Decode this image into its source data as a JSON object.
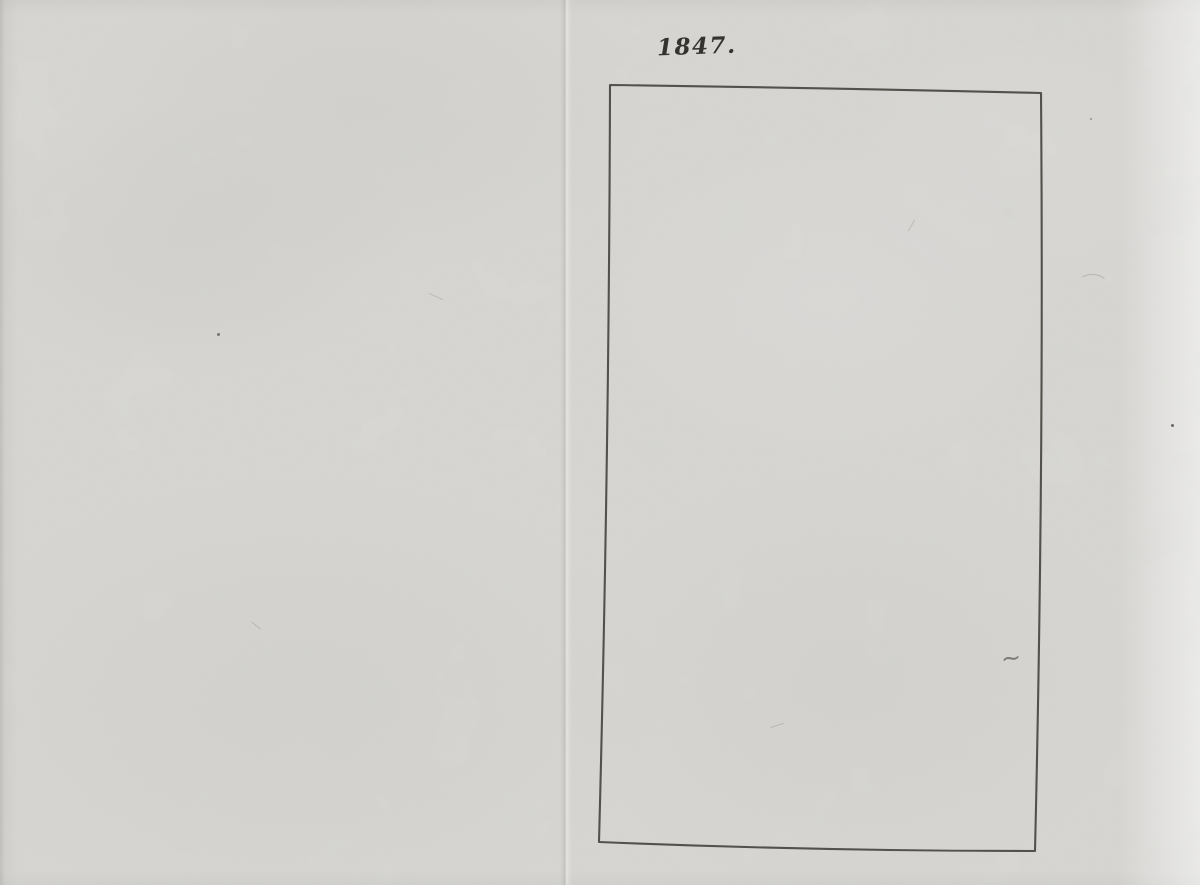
{
  "page": {
    "year_label": "1847.",
    "tilde_mark": "~"
  },
  "frame": {
    "path": "M 610 85 Q 828 88 1041 93 Q 1044 470 1035 851 Q 816 851 599 842 Q 609 463 610 85 Z"
  },
  "colors": {
    "paper": "#d8d7d4",
    "paper-light": "#e6e5e2",
    "ink": "#34332e",
    "frame-stroke": "#46453f"
  }
}
